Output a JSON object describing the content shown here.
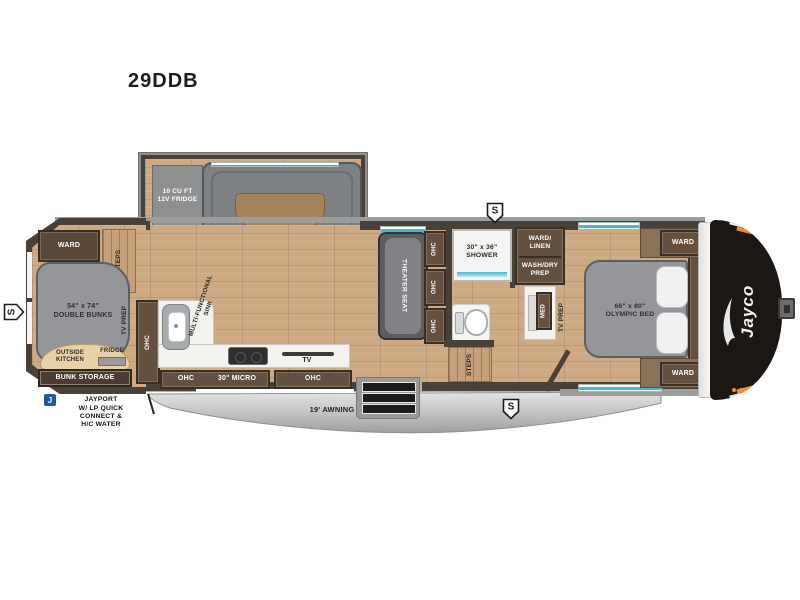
{
  "title": "29DDB",
  "colors": {
    "wall": "#494038",
    "floor_wood": "#cdaa84",
    "cabinet_brown": "#63503e",
    "furniture_gray": "#94969a",
    "counter_white": "#f3f2ee",
    "window_teal": "#4ab6ce",
    "awning_silver": "#c7c7c7",
    "front_cap_black": "#1a1715",
    "accent_orange": "#ef9130",
    "jayport_blue": "#2257a5"
  },
  "labels": {
    "fridge_12v": "10 CU FT\n12V FRIDGE",
    "ward": "WARD",
    "steps": "STEPS",
    "double_bunks": "54\" x 74\"\nDOUBLE BUNKS",
    "tv_prep": "TV PREP",
    "outside_kitchen": "OUTSIDE\nKITCHEN",
    "fridge": "FRIDGE",
    "bunk_storage": "BUNK STORAGE",
    "jayport_icon": "J",
    "jayport": "JAYPORT\nW/ LP QUICK\nCONNECT &\nH/C WATER",
    "speaker": "S",
    "ohc": "OHC",
    "multifunctional_sink": "MULTI-FUNCTIONAL\nSINK",
    "micro_30": "30\" MICRO",
    "tv": "TV",
    "theater_seat": "THEATER SEAT",
    "shower_30x36": "30\" x 36\"\nSHOWER",
    "ward_linen": "WARD/\nLINEN",
    "wash_dry_prep": "WASH/DRY\nPREP",
    "med": "MED",
    "olympic_bed": "66\" x 80\"\nOLYMPIC BED",
    "awning_19": "19' AWNING",
    "brand": "Jayco"
  }
}
